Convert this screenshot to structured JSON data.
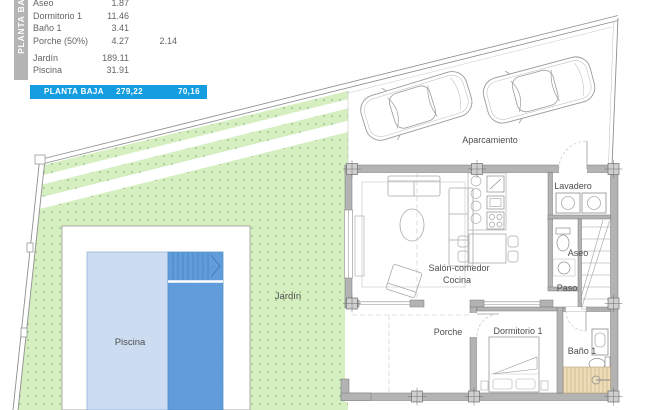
{
  "area_table": {
    "sidebar_label": "PLANTA BAJA",
    "rows": [
      {
        "name": "Aseo",
        "value": "1.87",
        "value2": ""
      },
      {
        "name": "Dormitorio 1",
        "value": "11.46",
        "value2": ""
      },
      {
        "name": "Baño 1",
        "value": "3.41",
        "value2": ""
      },
      {
        "name": "Porche (50%)",
        "value": "4.27",
        "value2": "2.14"
      },
      {
        "name": "Jardín",
        "value": "189.11",
        "value2": ""
      },
      {
        "name": "Piscina",
        "value": "31.91",
        "value2": ""
      }
    ],
    "total": {
      "label": "PLANTA BAJA",
      "value": "279,22",
      "value2": "70,16"
    }
  },
  "plan_labels": {
    "aparcamiento": "Aparcamiento",
    "lavadero": "Lavadero",
    "aseo": "Aseo",
    "paso": "Paso",
    "salon_comedor": "Salón-comedor",
    "cocina": "Cocina",
    "porche": "Porche",
    "dormitorio1": "Dormitorio 1",
    "bano1": "Baño 1",
    "jardin": "Jardín",
    "piscina": "Piscina"
  },
  "colors": {
    "accent_blue": "#159de2",
    "garden_green": "#d6efc1",
    "garden_dot": "#94b585",
    "pool_light": "#ccddf1",
    "pool_dark": "#5f9cd9",
    "wall_gray": "#b3b3b3",
    "shower_tan": "#ecdcb8",
    "table_text": "#646464"
  }
}
